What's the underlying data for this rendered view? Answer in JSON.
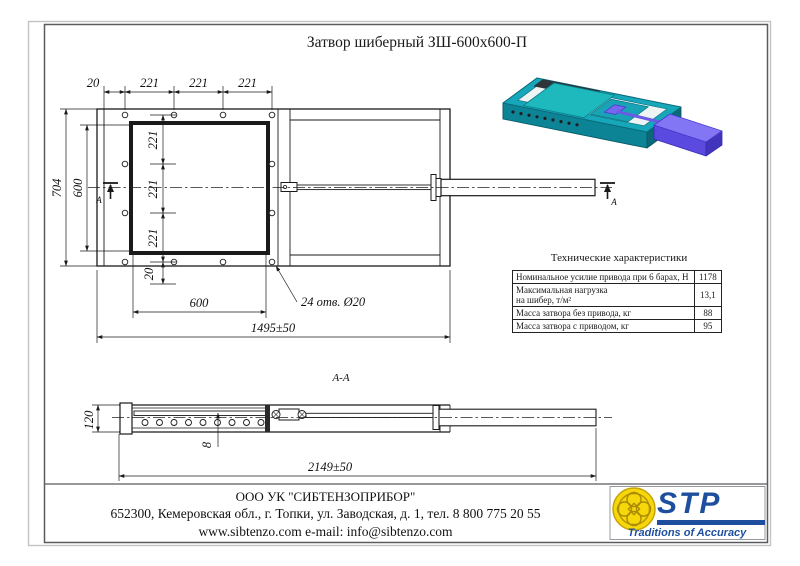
{
  "page": {
    "title": "Затвор шиберный ЗШ-600х600-П"
  },
  "views": {
    "plan": {
      "dim_edge": "20",
      "dim_pitch": [
        "221",
        "221",
        "221"
      ],
      "dim_height_outer": "704",
      "dim_height_inner": "600",
      "chain": [
        "221",
        "221",
        "221",
        "20"
      ],
      "dim_width_inner": "600",
      "holes_note": "24 отв. Ø20",
      "dim_overall": "1495±50",
      "section_mark": "A"
    },
    "section": {
      "label": "A-A",
      "dim_height": "120",
      "dim_gate": "8",
      "dim_overall": "2149±50"
    }
  },
  "specs": {
    "title": "Технические характеристики",
    "rows": [
      {
        "label": "Номинальное усилие привода при 6 барах, Н",
        "value": "1178"
      },
      {
        "label": "Максимальная нагрузка",
        "label2": "на шибер, т/м²",
        "value": "13,1"
      },
      {
        "label": "Масса затвора без привода, кг",
        "value": "88"
      },
      {
        "label": "Масса затвора с приводом, кг",
        "value": "95"
      }
    ]
  },
  "footer": {
    "company": "ООО УК \"СИБТЕНЗОПРИБОР\"",
    "address": "652300, Кемеровская обл., г. Топки, ул. Заводская, д. 1, тел. 8 800 775 20 55",
    "contacts": "www.sibtenzo.com e-mail: info@sibtenzo.com"
  },
  "logo": {
    "name": "STP",
    "tagline": "Traditions of Accuracy",
    "brand_color": "#1d4f9e",
    "emblem_color": "#f5d70a"
  },
  "colors": {
    "body_teal": "#16a8ba",
    "actuator_purple": "#5b4ae0",
    "line": "#1a1a1a"
  }
}
